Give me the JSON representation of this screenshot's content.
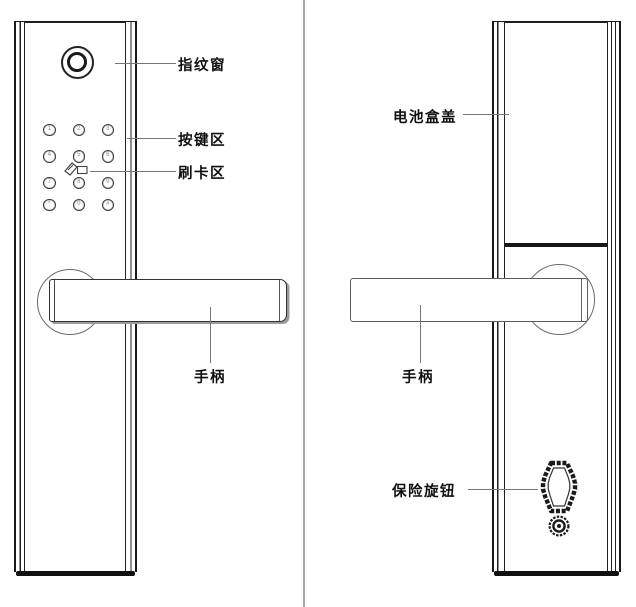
{
  "front_view": {
    "label_fingerprint": "指纹窗",
    "label_keypad": "按键区",
    "label_card": "刷卡区",
    "label_handle": "手柄",
    "keys": [
      "1",
      "2",
      "3",
      "4",
      "5",
      "6",
      "7",
      "8",
      "9",
      "*",
      "0",
      "#"
    ]
  },
  "back_view": {
    "label_battery": "电池盒盖",
    "label_handle": "手柄",
    "label_knob": "保险旋钮"
  },
  "icons": {
    "fingerprint_window": "fingerprint-window-icon",
    "card_swipe": "card-swipe-icon",
    "safety_knob": "safety-knob-icon",
    "screw": "screw-icon"
  },
  "colors": {
    "line": "#1a1a1a",
    "leader_line": "#777777",
    "divider": "#a9a9a9",
    "text": "#111111",
    "background": "#ffffff"
  }
}
